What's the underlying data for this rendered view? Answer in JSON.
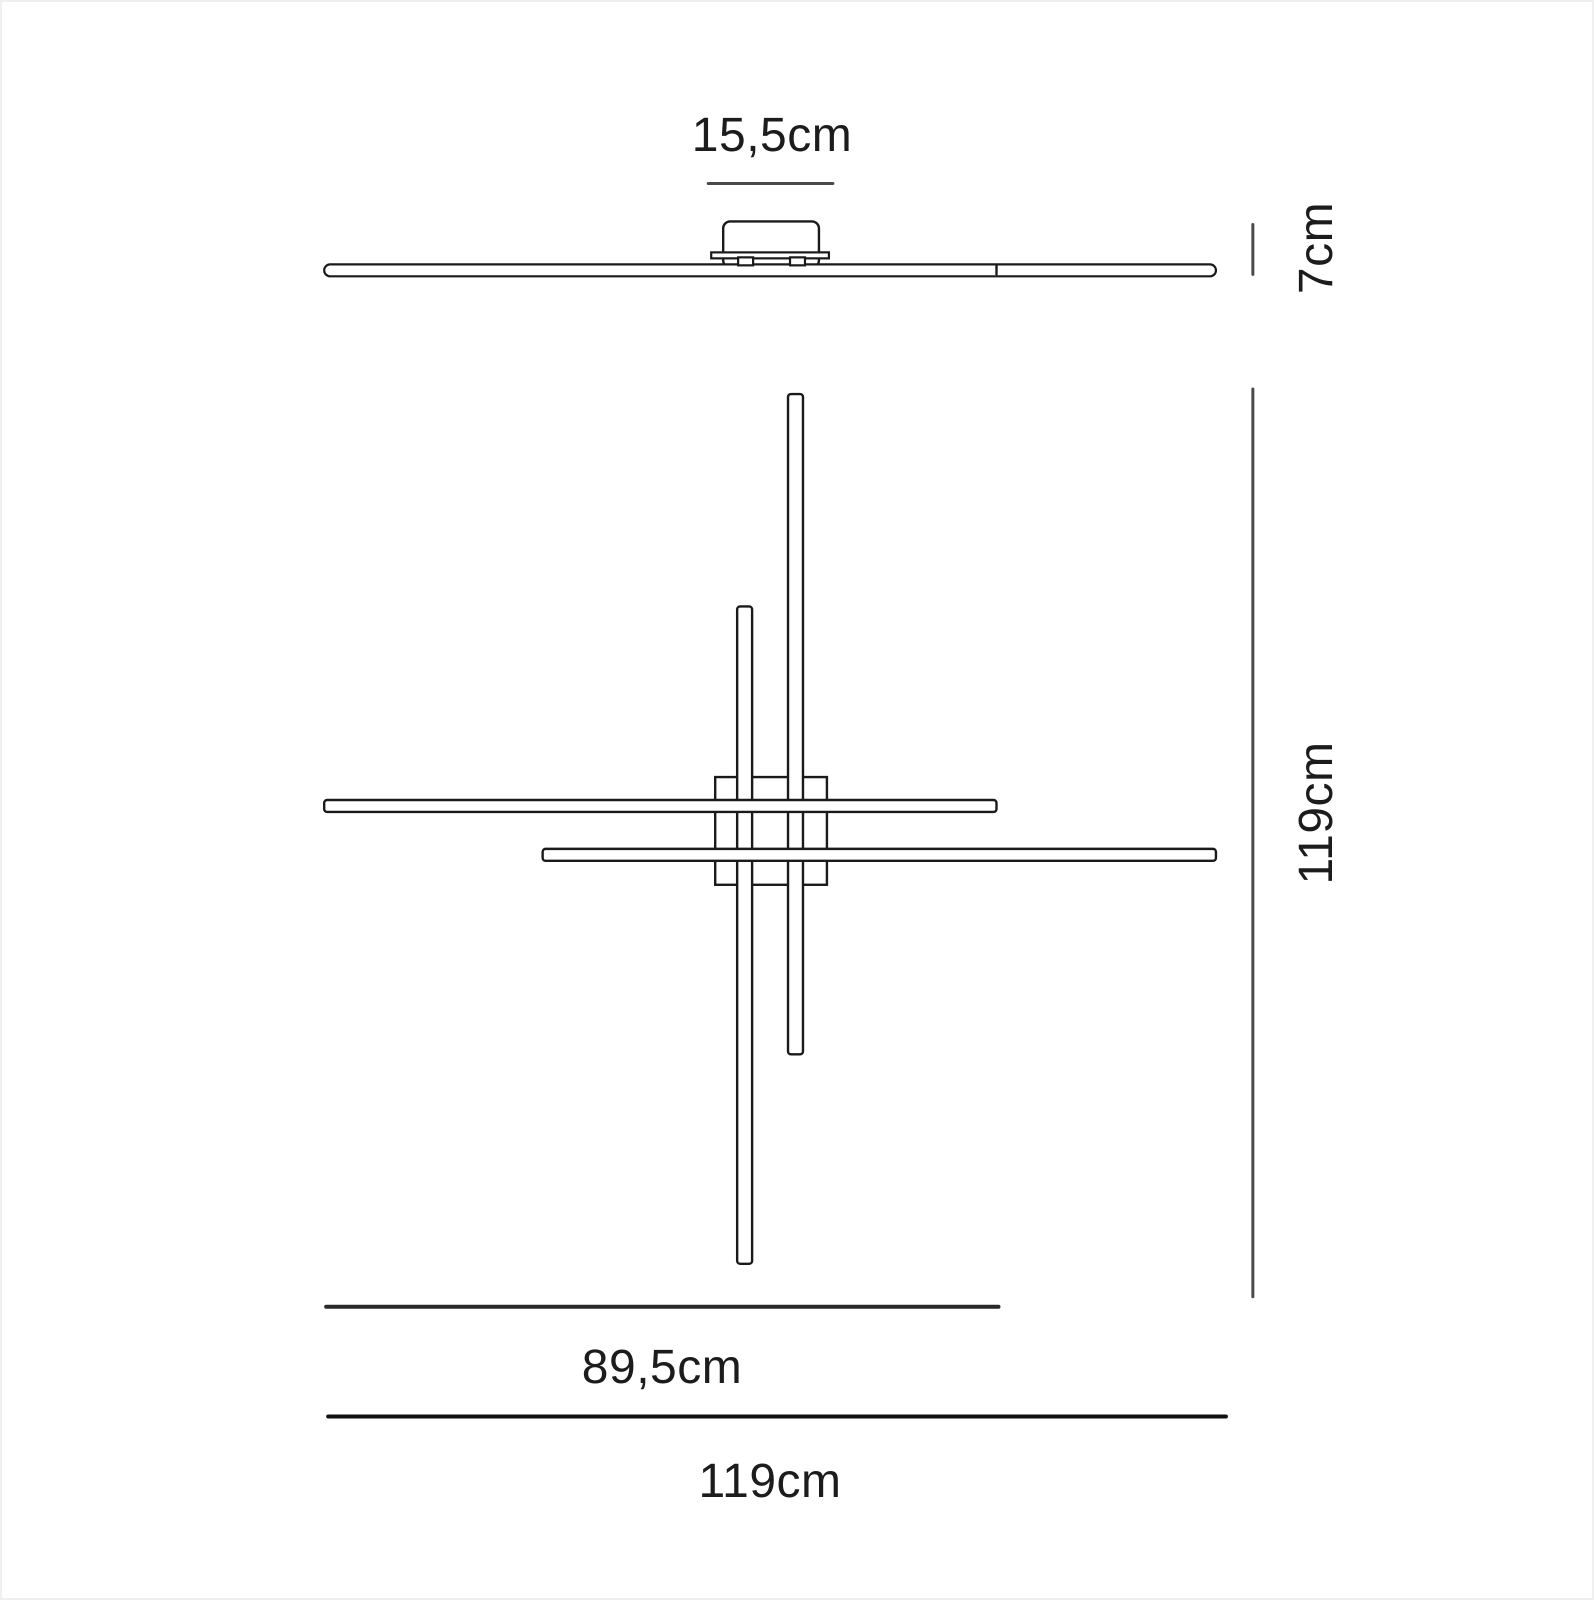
{
  "diagram": {
    "type": "technical-dimension-drawing",
    "subject": "linear ceiling lamp — side elevation (top) and plan view (bottom) with dimensions",
    "stroke_color": "#1a1a1a",
    "dim_line_color": "#4a4a4a",
    "background": "#ffffff",
    "labels": {
      "canopy_width": "15,5cm",
      "fixture_height": "7cm",
      "overall_height": "119cm",
      "bar_length": "89,5cm",
      "overall_width": "119cm"
    },
    "dimensions_cm": {
      "canopy_width": 15.5,
      "fixture_height": 7,
      "overall_height": 119,
      "overall_width": 119,
      "single_bar_length": 89.5
    }
  }
}
